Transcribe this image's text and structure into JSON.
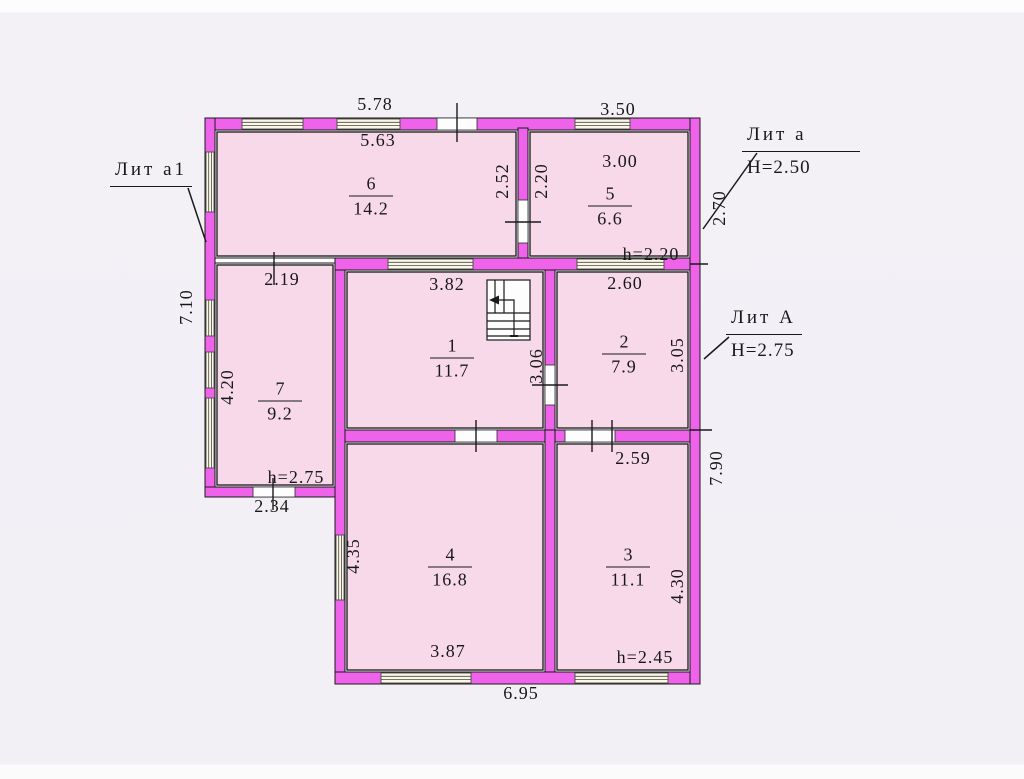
{
  "plan": {
    "buildings": [
      {
        "label": "Лит а1"
      },
      {
        "label": "Лит а",
        "height_note": "Н=2.50"
      },
      {
        "label": "Лит А",
        "height_note": "Н=2.75"
      }
    ],
    "rooms": [
      {
        "number": "1",
        "area": "11.7"
      },
      {
        "number": "2",
        "area": "7.9"
      },
      {
        "number": "3",
        "area": "11.1",
        "ceiling_height": "h=2.45"
      },
      {
        "number": "4",
        "area": "16.8"
      },
      {
        "number": "5",
        "area": "6.6",
        "ceiling_height": "h=2.20"
      },
      {
        "number": "6",
        "area": "14.2"
      },
      {
        "number": "7",
        "area": "9.2",
        "ceiling_height": "h=2.75"
      }
    ],
    "dims": {
      "top_left_outer": "5.78",
      "top_right_outer": "3.50",
      "room6_width": "5.63",
      "room5_width": "3.00",
      "room6_height": "2.52",
      "room5_height": "2.20",
      "annex_a_right": "2.70",
      "left_outer": "7.10",
      "room7_width": "2.19",
      "room1_width": "3.82",
      "room2_width": "2.60",
      "room1_height": "3.06",
      "room2_height": "3.05",
      "room7_height": "4.20",
      "room7_door_width": "2.34",
      "room3_top": "2.59",
      "main_right_outer": "7.90",
      "room4_height": "4.35",
      "room3_height": "4.30",
      "room4_width": "3.87",
      "bottom_outer": "6.95"
    },
    "colors": {
      "wall": "#ee63e9",
      "room_fill": "#f7d9e9",
      "background": "#f3f1f6",
      "line": "#1a1a1a"
    }
  }
}
